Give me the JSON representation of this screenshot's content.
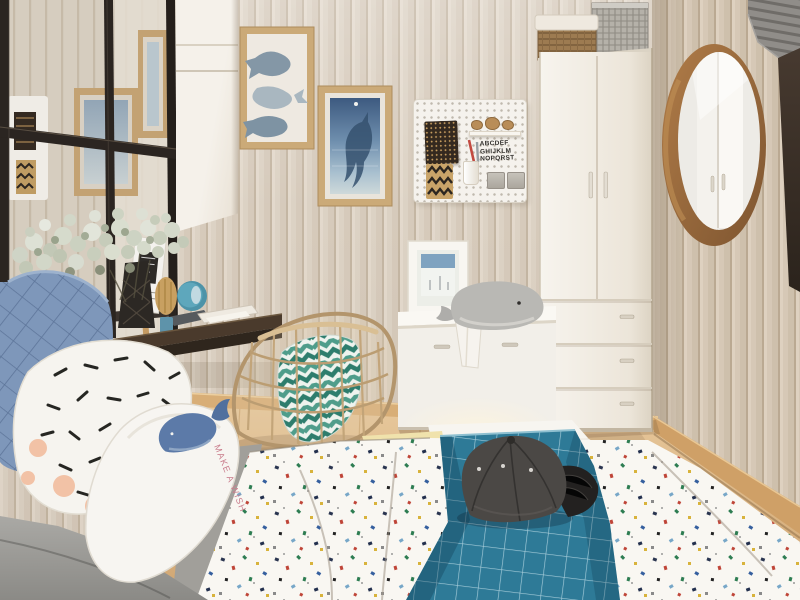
{
  "meta": {
    "type": "interior photograph",
    "subject": "Scandinavian kids bedroom with whale theme decor"
  },
  "texts": {
    "pegboard_line1": "ABCDEF",
    "pegboard_line2": "GHIJKLM",
    "pegboard_line3": "NOPQRST",
    "pillow_text": "MAKE A WISH"
  },
  "palette": {
    "wall": "#ddd3c6",
    "wall_right": "#d2c4b1",
    "floor": "#ddba8c",
    "baseboard": "#cfa067",
    "mirror_frame": "#2b2521",
    "frame_wood": "#cbaa78",
    "art_blue_deep": "#3d5a80",
    "art_blue_light": "#b9cbd4",
    "pegboard": "#f5f2ed",
    "wardrobe": "#f3efe8",
    "basket_brown": "#9d7b51",
    "basket_silver": "#b5b1a9",
    "round_mirror_wood": "#a5713f",
    "curtain_gray": "#908d89",
    "dark_panel": "#382d24",
    "desk_wood": "#3a2e23",
    "clock_teal": "#5ea7bc",
    "pillow_blue": "#7e97ba",
    "pillow_white": "#f6f4ef",
    "dash_black": "#262622",
    "dot_peach": "#f2c2a6",
    "whale_print_blue": "#5c7aa8",
    "pillow_text_pink": "#c97d8c",
    "duvet_white": "#f9f7f2",
    "blanket_teal": "#2e7a97",
    "cap_gray": "#4b4845",
    "cap_brim_black": "#232120",
    "chair_rattan": "#c2a478",
    "cushion_teal": "#4f9d8b",
    "plush_gray": "#b9b8b4",
    "flowers_sage": "#ccd1c2"
  },
  "objects": [
    {
      "name": "windowpane-mirror",
      "note": "black grid mirror leaning on left wall"
    },
    {
      "name": "gallery-frame-whales",
      "note": "wood frame with three watercolor whales"
    },
    {
      "name": "gallery-frame-ocean",
      "note": "wood frame with blue diving whale art"
    },
    {
      "name": "pegboard-organizer",
      "note": "white pegboard with cards, shelf, cup and alphabet print"
    },
    {
      "name": "wardrobe",
      "note": "tall white two-door wardrobe with three drawers"
    },
    {
      "name": "storage-baskets",
      "note": "wicker and silver baskets on wardrobe top"
    },
    {
      "name": "round-mirror",
      "note": "walnut round wall mirror"
    },
    {
      "name": "curtain",
      "note": "gray pleated curtain, top right"
    },
    {
      "name": "floating-desk",
      "note": "dark wood wall desk with vase, magazine, clock"
    },
    {
      "name": "baby-breath-flowers",
      "note": "white gypsophila bouquet"
    },
    {
      "name": "rattan-chair",
      "note": "wire basket chair with teal chevron cushion"
    },
    {
      "name": "storage-bench",
      "note": "white bench with photo frame and whale plush"
    },
    {
      "name": "bed",
      "note": "bed with confetti-print duvet and teal grid blanket"
    },
    {
      "name": "baseball-cap",
      "note": "dark gray cap on blanket"
    },
    {
      "name": "pillows",
      "note": "blue quilted, black-dash print, whale print pillows"
    }
  ]
}
